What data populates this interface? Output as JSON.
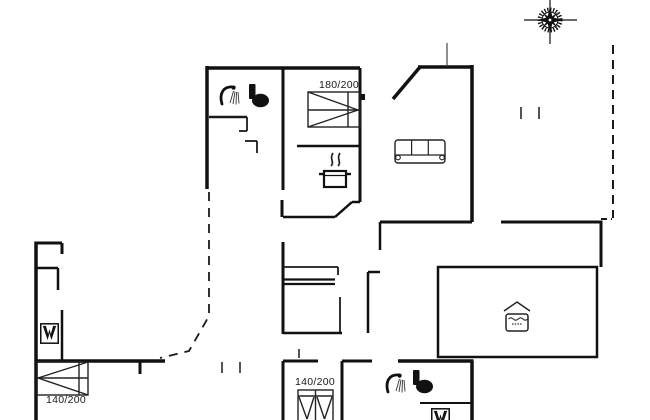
{
  "document": {
    "kind": "holiday-home floor plan drawing"
  },
  "labels": {
    "bed_180": "180/200",
    "bed_140_left": "140/200",
    "bed_140_center": "140/200"
  },
  "colors": {
    "background": "#ffffff",
    "walls": "#111111",
    "furniture": "#222222"
  },
  "icons": [
    "compass-rose-icon",
    "shower-icon",
    "toilet-icon",
    "cooking-pot-icon",
    "sofa-icon",
    "pool-icon",
    "wardrobe-appliance-icon",
    "double-bed-icon",
    "single-bed-icon"
  ]
}
